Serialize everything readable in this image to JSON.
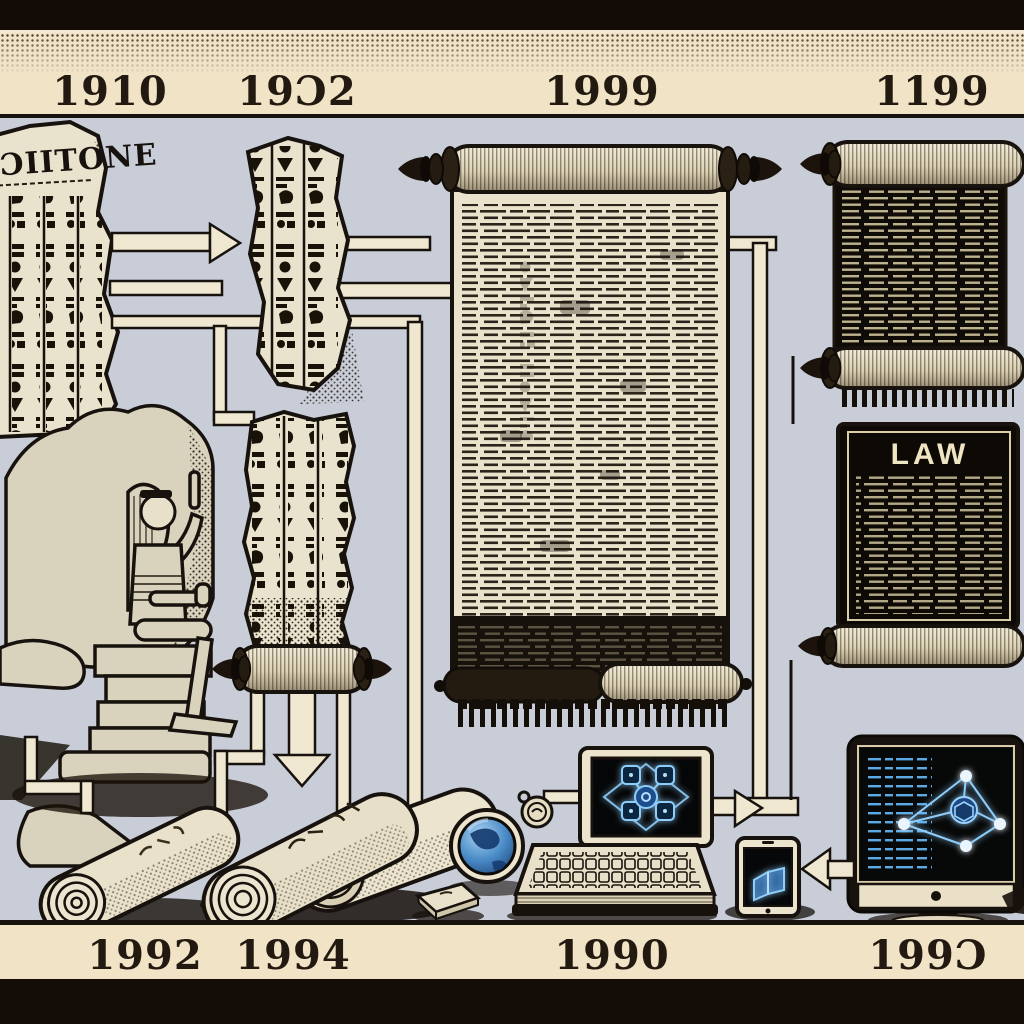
{
  "scene": {
    "description": "Illustrated timeline of written law: hieroglyph stone tablets and scribe statue evolving into papyrus scrolls, a LAW scroll, and modern digital devices",
    "panel_color": "#c8cdd8",
    "band_color": "#f1e3c6",
    "outer_color": "#140d07",
    "parchment_color": "#e9e2cc",
    "ink_color": "#17120d",
    "glow_blue": "#8ecdf9",
    "globe_blue": "#4a8cc8"
  },
  "timeline": {
    "top_labels": [
      "1910",
      "19Ɔ2",
      "1999",
      "1199"
    ],
    "bottom_labels": [
      "1992",
      "1994",
      "1990",
      "199Ɔ"
    ]
  },
  "inscriptions": {
    "stone_tablet": "ƆIITONE",
    "law_scroll": "LAW"
  },
  "icons": [
    "hieroglyph-stone-tablet",
    "hieroglyph-fragment",
    "scribe-statue",
    "tall-hieroglyph-tablet",
    "large-papyrus-scroll",
    "dark-text-scroll",
    "law-scroll",
    "papyrus-roll",
    "papyrus-rolls-pair",
    "closed-book",
    "globe",
    "seal-coin",
    "monitor-network",
    "keyboard-book",
    "tablet-ebook",
    "imac-network",
    "arrow-connectors"
  ]
}
